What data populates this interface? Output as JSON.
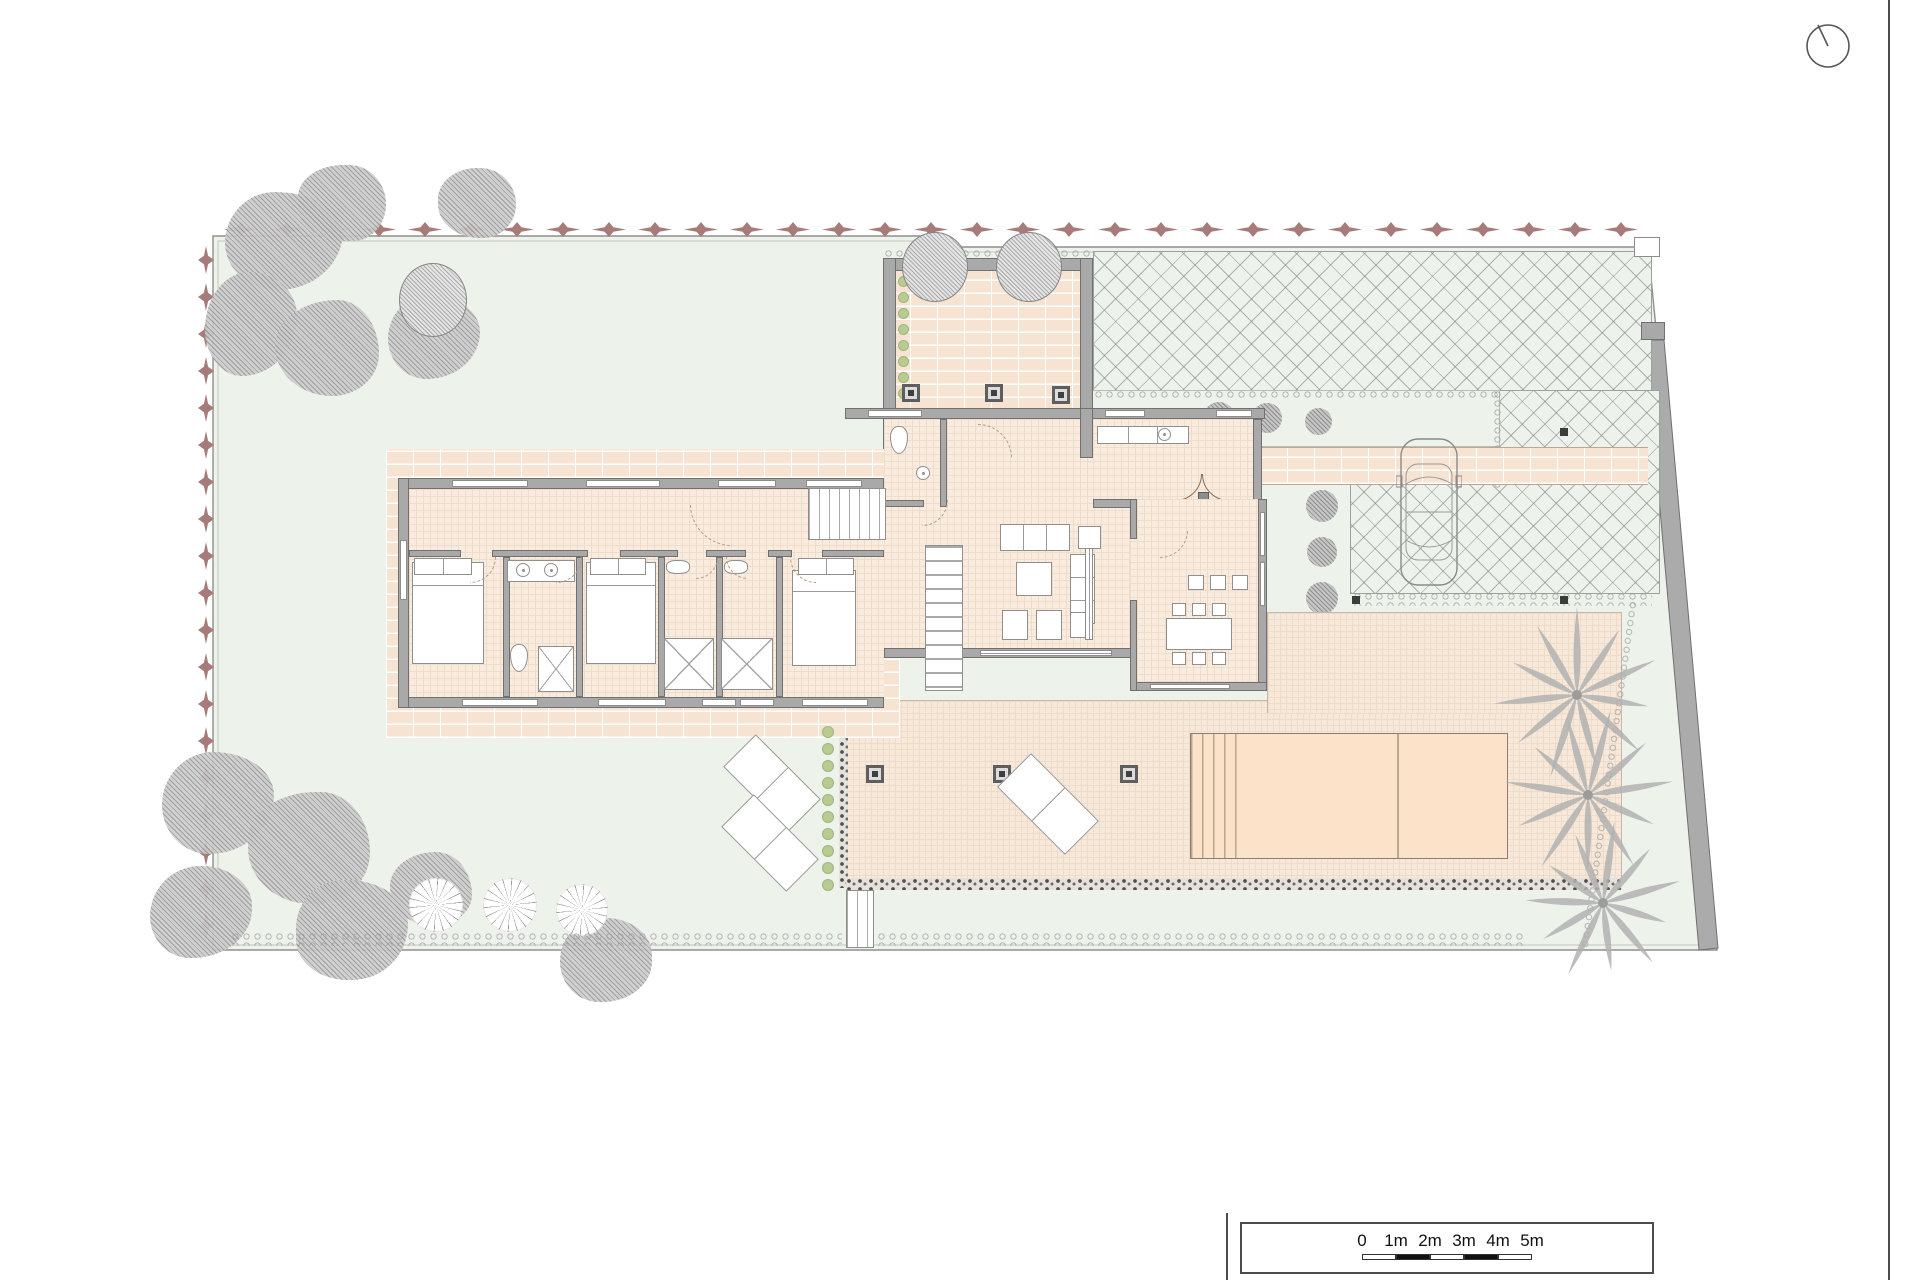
{
  "north_indicator": {
    "name": "north-indicator",
    "shape": "circle-with-needle"
  },
  "scale_bar": {
    "labels": [
      "0",
      "1m",
      "2m",
      "3m",
      "4m",
      "5m"
    ],
    "segments": 5,
    "meters_per_segment": 1
  },
  "palette": {
    "paper": "#ffffff",
    "lawn": "#edf2ea",
    "floor": "#f9ecde",
    "brick_paving": "#f6e3d1",
    "terrace": "#f8e8d9",
    "pool": "#fbe2c8",
    "wall": "#a9a9a9",
    "wall_edge": "#707070",
    "hedge": "#a87b7b",
    "tree_gray": "#cdcdcd",
    "shrub_green": "#b8cb92",
    "boundary": "#8f8f8f"
  }
}
